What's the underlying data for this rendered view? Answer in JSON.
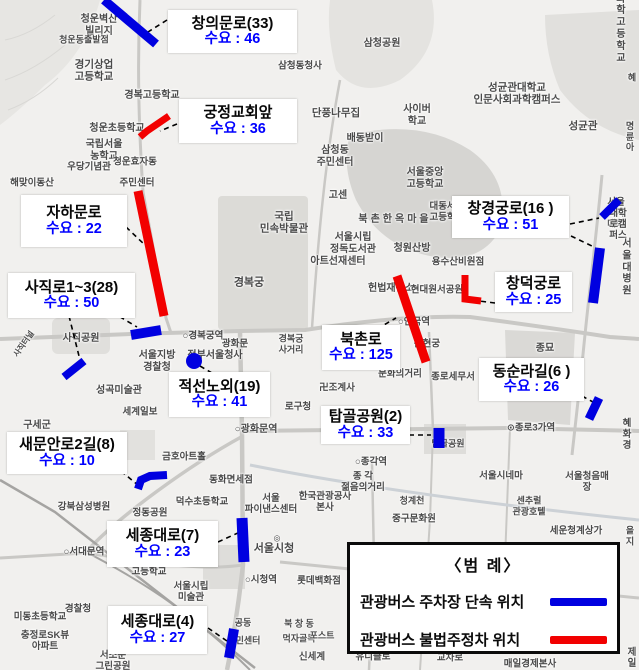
{
  "colors": {
    "enforcement": "#0000e0",
    "illegal": "#f20000",
    "demand_text": "#0000ff",
    "connector": "#000000"
  },
  "legend": {
    "title": "〈범  례〉",
    "items": [
      {
        "label": "관광버스 주차장 단속 위치",
        "color": "#0000e0"
      },
      {
        "label": "관광버스 불법주정차 위치",
        "color": "#f20000"
      }
    ]
  },
  "annotations": [
    {
      "t": "창의문로(33)",
      "v": "수요 : 46",
      "x": 168,
      "y": 10,
      "w": 129,
      "h": 43
    },
    {
      "t": "궁정교회앞",
      "v": "수요 : 36",
      "x": 179,
      "y": 99,
      "w": 118,
      "h": 44
    },
    {
      "t": "자하문로",
      "v": "수요 : 22",
      "x": 21,
      "y": 195,
      "w": 106,
      "h": 52
    },
    {
      "t": "사직로1~3(28)",
      "v": "수요 : 50",
      "x": 8,
      "y": 273,
      "w": 127,
      "h": 45
    },
    {
      "t": "적선노외(19)",
      "v": "수요 : 41",
      "x": 169,
      "y": 372,
      "w": 101,
      "h": 45
    },
    {
      "t": "새문안로2길(8)",
      "v": "수요 : 10",
      "x": 7,
      "y": 432,
      "w": 120,
      "h": 42
    },
    {
      "t": "세종대로(7)",
      "v": "수요 : 23",
      "x": 107,
      "y": 521,
      "w": 111,
      "h": 46
    },
    {
      "t": "세종대로(4)",
      "v": "수요 : 27",
      "x": 108,
      "y": 606,
      "w": 99,
      "h": 48
    },
    {
      "t": "북촌로",
      "v": "수요 : 125",
      "x": 322,
      "y": 325,
      "w": 78,
      "h": 45
    },
    {
      "t": "탑골공원(2)",
      "v": "수요 : 33",
      "x": 321,
      "y": 406,
      "w": 89,
      "h": 38
    },
    {
      "t": "창경궁로(16 )",
      "v": "수요 : 51",
      "x": 452,
      "y": 196,
      "w": 117,
      "h": 42
    },
    {
      "t": "창덕궁로",
      "v": "수요 : 25",
      "x": 495,
      "y": 272,
      "w": 77,
      "h": 40
    },
    {
      "t": "동순라길(6 )",
      "v": "수요 : 26",
      "x": 479,
      "y": 358,
      "w": 105,
      "h": 43
    }
  ],
  "segments": [
    {
      "type": "enforcement",
      "shape": "line",
      "points": [
        [
          104,
          0
        ],
        [
          156,
          44
        ]
      ],
      "w": 9
    },
    {
      "type": "illegal",
      "shape": "poly",
      "points": [
        [
          140,
          137
        ],
        [
          147,
          131
        ],
        [
          169,
          116
        ]
      ],
      "w": 7
    },
    {
      "type": "illegal",
      "shape": "line",
      "points": [
        [
          138,
          191
        ],
        [
          164,
          316
        ]
      ],
      "w": 9
    },
    {
      "type": "enforcement",
      "shape": "line",
      "points": [
        [
          131,
          335
        ],
        [
          161,
          330
        ]
      ],
      "w": 10
    },
    {
      "type": "enforcement",
      "shape": "line",
      "points": [
        [
          64,
          377
        ],
        [
          84,
          361
        ]
      ],
      "w": 8
    },
    {
      "type": "enforcement",
      "shape": "dot",
      "points": [
        [
          194,
          361
        ]
      ],
      "r": 8
    },
    {
      "type": "enforcement",
      "shape": "poly",
      "points": [
        [
          138,
          489
        ],
        [
          141,
          480
        ],
        [
          150,
          476
        ],
        [
          167,
          475
        ]
      ],
      "w": 8
    },
    {
      "type": "enforcement",
      "shape": "line",
      "points": [
        [
          242,
          518
        ],
        [
          244,
          562
        ]
      ],
      "w": 11
    },
    {
      "type": "enforcement",
      "shape": "line",
      "points": [
        [
          234,
          629
        ],
        [
          229,
          658
        ]
      ],
      "w": 10
    },
    {
      "type": "illegal",
      "shape": "line",
      "points": [
        [
          397,
          276
        ],
        [
          426,
          362
        ]
      ],
      "w": 9
    },
    {
      "type": "illegal",
      "shape": "poly",
      "points": [
        [
          465,
          275
        ],
        [
          465,
          299
        ],
        [
          481,
          301
        ]
      ],
      "w": 7
    },
    {
      "type": "enforcement",
      "shape": "line",
      "points": [
        [
          602,
          217
        ],
        [
          619,
          200
        ]
      ],
      "w": 8
    },
    {
      "type": "enforcement",
      "shape": "line",
      "points": [
        [
          600,
          248
        ],
        [
          593,
          303
        ]
      ],
      "w": 10
    },
    {
      "type": "enforcement",
      "shape": "line",
      "points": [
        [
          599,
          398
        ],
        [
          589,
          419
        ]
      ],
      "w": 9
    },
    {
      "type": "enforcement",
      "shape": "line",
      "points": [
        [
          439,
          428
        ],
        [
          439,
          448
        ]
      ],
      "w": 11
    }
  ],
  "connectors": [
    [
      167,
      20,
      148,
      32
    ],
    [
      177,
      124,
      160,
      131
    ],
    [
      126,
      227,
      146,
      246
    ],
    [
      69,
      316,
      79,
      356
    ],
    [
      112,
      312,
      137,
      327
    ],
    [
      200,
      366,
      217,
      376
    ],
    [
      121,
      471,
      139,
      486
    ],
    [
      218,
      542,
      240,
      532
    ],
    [
      208,
      628,
      227,
      641
    ],
    [
      377,
      329,
      396,
      318
    ],
    [
      409,
      435,
      431,
      435
    ],
    [
      570,
      224,
      599,
      218
    ],
    [
      571,
      236,
      594,
      247
    ],
    [
      495,
      303,
      479,
      301
    ],
    [
      582,
      396,
      593,
      402
    ]
  ],
  "map_labels": [
    {
      "text": "청운벽산\n빌리지",
      "x": 99,
      "y": 26,
      "fs": 10
    },
    {
      "text": "청운동출발점",
      "x": 84,
      "y": 40,
      "fs": 9
    },
    {
      "text": "경기상업\n고등학교",
      "x": 94,
      "y": 71,
      "fs": 10.5
    },
    {
      "text": "경복고등학교",
      "x": 152,
      "y": 96,
      "fs": 10
    },
    {
      "text": "청운초등학교",
      "x": 117,
      "y": 129,
      "fs": 10
    },
    {
      "text": "국립서울\n농학교",
      "x": 104,
      "y": 151,
      "fs": 10
    },
    {
      "text": "우당기념관",
      "x": 89,
      "y": 167,
      "fs": 9.5
    },
    {
      "text": "청운효자동",
      "x": 135,
      "y": 162,
      "fs": 9.5
    },
    {
      "text": "주민센터",
      "x": 137,
      "y": 183,
      "fs": 9.5
    },
    {
      "text": "해맞이동산",
      "x": 32,
      "y": 183,
      "fs": 9.5
    },
    {
      "text": "삼청공원",
      "x": 382,
      "y": 44,
      "fs": 10
    },
    {
      "text": "삼청동청사",
      "x": 300,
      "y": 66,
      "fs": 9.5
    },
    {
      "text": "단풍나무집",
      "x": 336,
      "y": 113,
      "fs": 10.5
    },
    {
      "text": "사이버\n학교",
      "x": 417,
      "y": 116,
      "fs": 10
    },
    {
      "text": "배동받이",
      "x": 365,
      "y": 139,
      "fs": 10
    },
    {
      "text": "삼청동\n주민센터",
      "x": 335,
      "y": 157,
      "fs": 10
    },
    {
      "text": "서울중앙\n고등학교",
      "x": 425,
      "y": 179,
      "fs": 10
    },
    {
      "text": "성균관대학교\n인문사회과학캠퍼스",
      "x": 517,
      "y": 94,
      "fs": 10.5
    },
    {
      "text": "성균관",
      "x": 583,
      "y": 126,
      "fs": 10.5
    },
    {
      "text": "서울과학\n고등학교",
      "x": 621,
      "y": 17,
      "fs": 10
    },
    {
      "text": "혜",
      "x": 632,
      "y": 78,
      "fs": 9
    },
    {
      "text": "명륜\n아",
      "x": 630,
      "y": 137,
      "fs": 9
    },
    {
      "text": "고센",
      "x": 338,
      "y": 196,
      "fs": 10
    },
    {
      "text": "북촌한옥마을",
      "x": 395,
      "y": 220,
      "fs": 10,
      "ls": 3
    },
    {
      "text": "대동세무\n고등학교",
      "x": 447,
      "y": 212,
      "fs": 9.5
    },
    {
      "text": "서울시립\n정독도서관",
      "x": 353,
      "y": 244,
      "fs": 10
    },
    {
      "text": "청원산방",
      "x": 412,
      "y": 249,
      "fs": 10
    },
    {
      "text": "아트선재센터",
      "x": 338,
      "y": 262,
      "fs": 10
    },
    {
      "text": "국립\n민속박물관",
      "x": 284,
      "y": 223,
      "fs": 10.5
    },
    {
      "text": "경복궁",
      "x": 249,
      "y": 283,
      "fs": 11
    },
    {
      "text": "용수산비원점",
      "x": 458,
      "y": 262,
      "fs": 9.5
    },
    {
      "text": "헌법재판소",
      "x": 391,
      "y": 289,
      "fs": 10
    },
    {
      "text": "현대원서공원",
      "x": 437,
      "y": 290,
      "fs": 9.5
    },
    {
      "text": "서울여자대학",
      "x": 616,
      "y": 214,
      "fs": 9.5
    },
    {
      "text": "대학로캠퍼스",
      "x": 618,
      "y": 225,
      "fs": 9.5
    },
    {
      "text": "서울대\n병원",
      "x": 627,
      "y": 268,
      "fs": 10
    },
    {
      "text": "○경복궁역",
      "x": 203,
      "y": 336,
      "fs": 9.5
    },
    {
      "text": "광화문",
      "x": 235,
      "y": 344,
      "fs": 9.5
    },
    {
      "text": "경복궁\n사거리",
      "x": 291,
      "y": 344,
      "fs": 9
    },
    {
      "text": "서울지방\n경찰청",
      "x": 157,
      "y": 362,
      "fs": 10
    },
    {
      "text": "정부서울청사",
      "x": 215,
      "y": 356,
      "fs": 10
    },
    {
      "text": "사직공원",
      "x": 81,
      "y": 339,
      "fs": 10
    },
    {
      "text": "사직터널",
      "x": 24,
      "y": 344,
      "fs": 8,
      "rot": -55
    },
    {
      "text": "성곡미술관",
      "x": 119,
      "y": 391,
      "fs": 10
    },
    {
      "text": "세계일보",
      "x": 140,
      "y": 412,
      "fs": 9.5
    },
    {
      "text": "구세군",
      "x": 37,
      "y": 426,
      "fs": 10
    },
    {
      "text": "○광화문역",
      "x": 256,
      "y": 430,
      "fs": 10
    },
    {
      "text": "로구청",
      "x": 298,
      "y": 407,
      "fs": 9.5
    },
    {
      "text": "금호아트홀",
      "x": 184,
      "y": 457,
      "fs": 9.5
    },
    {
      "text": "동화면세점",
      "x": 231,
      "y": 480,
      "fs": 9.5
    },
    {
      "text": "덕수초등학교",
      "x": 202,
      "y": 502,
      "fs": 9.5
    },
    {
      "text": "서울\n파이낸스센터",
      "x": 271,
      "y": 504,
      "fs": 9.5
    },
    {
      "text": "한국관광공사\n본사",
      "x": 325,
      "y": 502,
      "fs": 9.5
    },
    {
      "text": "강북삼성병원",
      "x": 84,
      "y": 507,
      "fs": 9.5
    },
    {
      "text": "정동공원",
      "x": 150,
      "y": 513,
      "fs": 9.5
    },
    {
      "text": "청계천",
      "x": 412,
      "y": 501,
      "fs": 9
    },
    {
      "text": "중구문화원",
      "x": 414,
      "y": 519,
      "fs": 9.5
    },
    {
      "text": "세운청계상가",
      "x": 576,
      "y": 531,
      "fs": 9.5
    },
    {
      "text": "서울시네마",
      "x": 501,
      "y": 476,
      "fs": 9.5
    },
    {
      "text": "서울청음매장",
      "x": 587,
      "y": 482,
      "fs": 9.5
    },
    {
      "text": "센추럴\n관광호텔",
      "x": 529,
      "y": 506,
      "fs": 9
    },
    {
      "text": "○종각역",
      "x": 371,
      "y": 462,
      "fs": 9.5
    },
    {
      "text": "종 각\n젊음의거리",
      "x": 363,
      "y": 482,
      "fs": 9.5
    },
    {
      "text": "⊙종로3가역",
      "x": 531,
      "y": 428,
      "fs": 9.5
    },
    {
      "text": "혜화경",
      "x": 627,
      "y": 435,
      "fs": 9.5
    },
    {
      "text": "종묘",
      "x": 545,
      "y": 349,
      "fs": 10
    },
    {
      "text": "문화의거리",
      "x": 400,
      "y": 374,
      "fs": 9.5
    },
    {
      "text": "종로세무서",
      "x": 453,
      "y": 377,
      "fs": 9.5
    },
    {
      "text": "卍조계사",
      "x": 337,
      "y": 388,
      "fs": 9.5
    },
    {
      "text": "○안국역",
      "x": 414,
      "y": 322,
      "fs": 9.5
    },
    {
      "text": "운현궁",
      "x": 427,
      "y": 344,
      "fs": 9.5
    },
    {
      "text": "탑골공원",
      "x": 448,
      "y": 444,
      "fs": 9
    },
    {
      "text": "○서대문역",
      "x": 84,
      "y": 552,
      "fs": 9.5
    },
    {
      "text": "고등학교",
      "x": 149,
      "y": 572,
      "fs": 9.5
    },
    {
      "text": "서울시립\n미술관",
      "x": 191,
      "y": 592,
      "fs": 9.5
    },
    {
      "text": "경찰청",
      "x": 78,
      "y": 609,
      "fs": 9.5
    },
    {
      "text": "미동초등학교",
      "x": 40,
      "y": 617,
      "fs": 9.5
    },
    {
      "text": "충정로SK뷰\n아파트",
      "x": 45,
      "y": 641,
      "fs": 9.5
    },
    {
      "text": "서소문\n그린공원",
      "x": 113,
      "y": 661,
      "fs": 9.5
    },
    {
      "text": "◎",
      "x": 277,
      "y": 538,
      "fs": 8
    },
    {
      "text": "서울시청",
      "x": 274,
      "y": 549,
      "fs": 11
    },
    {
      "text": "○시청역",
      "x": 261,
      "y": 580,
      "fs": 9.5
    },
    {
      "text": "롯데백화점",
      "x": 319,
      "y": 581,
      "fs": 9.5
    },
    {
      "text": "북 창 동",
      "x": 299,
      "y": 624,
      "fs": 9
    },
    {
      "text": "먹자골목",
      "x": 299,
      "y": 639,
      "fs": 9
    },
    {
      "text": "공동",
      "x": 243,
      "y": 623,
      "fs": 9
    },
    {
      "text": "민센터",
      "x": 248,
      "y": 641,
      "fs": 9
    },
    {
      "text": "신세계",
      "x": 312,
      "y": 657,
      "fs": 9.5
    },
    {
      "text": "포스트",
      "x": 322,
      "y": 636,
      "fs": 9
    },
    {
      "text": "유니클로",
      "x": 373,
      "y": 657,
      "fs": 9.5
    },
    {
      "text": "교차로",
      "x": 450,
      "y": 658,
      "fs": 9.5
    },
    {
      "text": "매일경제본사",
      "x": 530,
      "y": 664,
      "fs": 9.5
    },
    {
      "text": "제일",
      "x": 632,
      "y": 658,
      "fs": 9.5
    },
    {
      "text": "을지",
      "x": 630,
      "y": 536,
      "fs": 9
    }
  ]
}
